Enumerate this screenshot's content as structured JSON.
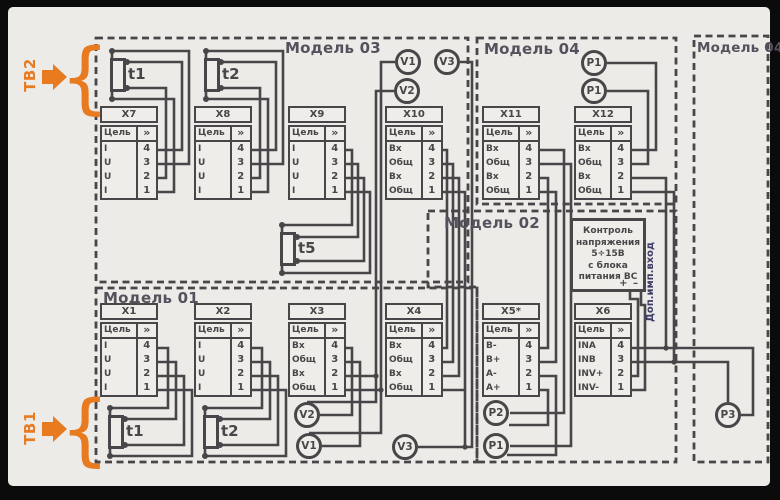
{
  "colors": {
    "ink": "#4a4549",
    "orange": "#e87a20",
    "canvas": "#ecebe8",
    "dop_navy": "#3e3b66"
  },
  "labels": {
    "tb1": "ТВ1",
    "tb2": "ТВ2",
    "brace": "{",
    "dop_imp": "Доп.имп.вход"
  },
  "models": {
    "m01": "Модель 01",
    "m02": "Модель 02",
    "m03": "Модель 03",
    "m04": "Модель 04",
    "m04r": "Модель 04Р"
  },
  "connector_header": {
    "col1": "Цель",
    "col2": "»"
  },
  "connectors": [
    {
      "id": "x1",
      "title": "X1",
      "signals": [
        "I",
        "U",
        "U",
        "I"
      ],
      "pins": [
        "4",
        "3",
        "2",
        "1"
      ]
    },
    {
      "id": "x2",
      "title": "X2",
      "signals": [
        "I",
        "U",
        "U",
        "I"
      ],
      "pins": [
        "4",
        "3",
        "2",
        "1"
      ]
    },
    {
      "id": "x3",
      "title": "X3",
      "signals": [
        "Вх",
        "Общ",
        "Вх",
        "Общ"
      ],
      "pins": [
        "4",
        "3",
        "2",
        "1"
      ]
    },
    {
      "id": "x4",
      "title": "X4",
      "signals": [
        "Вх",
        "Общ",
        "Вх",
        "Общ"
      ],
      "pins": [
        "4",
        "3",
        "2",
        "1"
      ]
    },
    {
      "id": "x5",
      "title": "X5*",
      "signals": [
        "В-",
        "В+",
        "А-",
        "А+"
      ],
      "pins": [
        "4",
        "3",
        "2",
        "1"
      ]
    },
    {
      "id": "x6",
      "title": "X6",
      "signals": [
        "INA",
        "INB",
        "INV+",
        "INV-"
      ],
      "pins": [
        "4",
        "3",
        "2",
        "1"
      ]
    },
    {
      "id": "x7",
      "title": "X7",
      "signals": [
        "I",
        "U",
        "U",
        "I"
      ],
      "pins": [
        "4",
        "3",
        "2",
        "1"
      ]
    },
    {
      "id": "x8",
      "title": "X8",
      "signals": [
        "I",
        "U",
        "U",
        "I"
      ],
      "pins": [
        "4",
        "3",
        "2",
        "1"
      ]
    },
    {
      "id": "x9",
      "title": "X9",
      "signals": [
        "I",
        "U",
        "U",
        "I"
      ],
      "pins": [
        "4",
        "3",
        "2",
        "1"
      ]
    },
    {
      "id": "x10",
      "title": "X10",
      "signals": [
        "Вх",
        "Общ",
        "Вх",
        "Общ"
      ],
      "pins": [
        "4",
        "3",
        "2",
        "1"
      ]
    },
    {
      "id": "x11",
      "title": "X11",
      "signals": [
        "Вх",
        "Общ",
        "Вх",
        "Общ"
      ],
      "pins": [
        "4",
        "3",
        "2",
        "1"
      ]
    },
    {
      "id": "x12",
      "title": "X12",
      "signals": [
        "Вх",
        "Общ",
        "Вх",
        "Общ"
      ],
      "pins": [
        "4",
        "3",
        "2",
        "1"
      ]
    }
  ],
  "sensors": {
    "t1_top": "t1",
    "t2_top": "t2",
    "t5": "t5",
    "t1_bot": "t1",
    "t2_bot": "t2"
  },
  "circles": {
    "v1_top": "V1",
    "v3_top": "V3",
    "v2_top": "V2",
    "p1_m04_a": "P1",
    "p1_m04_b": "P1",
    "v2_m01": "V2",
    "v1_m01": "V1",
    "v3_m01": "V3",
    "p2_m02": "P2",
    "p1_m02": "P1",
    "p3_m04r": "P3"
  },
  "control_box": {
    "lines": [
      "Контроль",
      "напряжения",
      "5÷15В",
      "с блока",
      "питания ВС"
    ],
    "terminals": "+ –"
  }
}
